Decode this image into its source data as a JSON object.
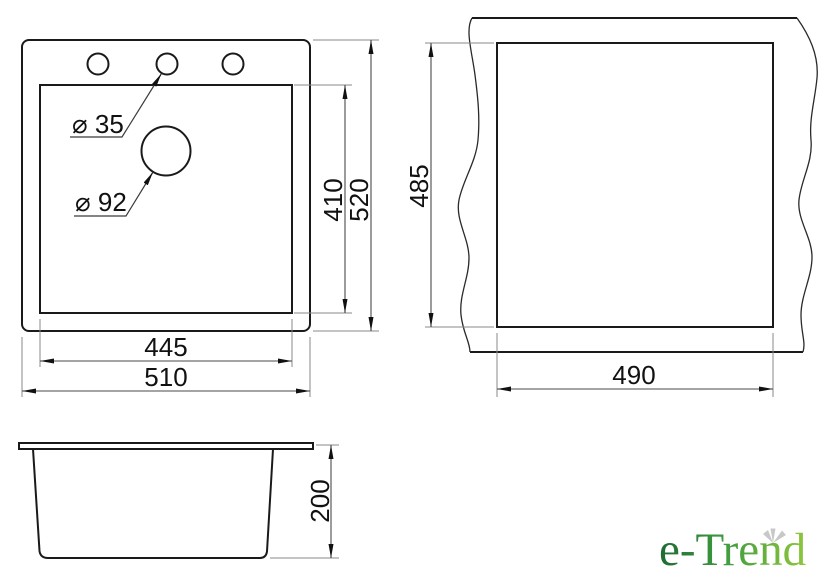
{
  "top_view": {
    "labels": {
      "tap_hole_diameter": "⌀ 35",
      "main_hole_diameter": "⌀ 92"
    },
    "dimensions": {
      "bowl_depth": "410",
      "overall_depth": "520",
      "bowl_width": "445",
      "overall_width": "510"
    }
  },
  "cutout_view": {
    "dimensions": {
      "cutout_depth": "485",
      "cutout_width": "490"
    }
  },
  "side_view": {
    "dimensions": {
      "height": "200"
    }
  },
  "logo": {
    "text": "e-Trend"
  },
  "colors": {
    "background": "#ffffff",
    "object_line": "#1a1a1a",
    "dimension_line": "#4a4a4a",
    "text": "#111111",
    "logo_gradient_start": "#1e6a34",
    "logo_gradient_mid": "#3f9c3f",
    "logo_gradient_end": "#8fc63e",
    "logo_leaf": "#c8c8c8"
  }
}
